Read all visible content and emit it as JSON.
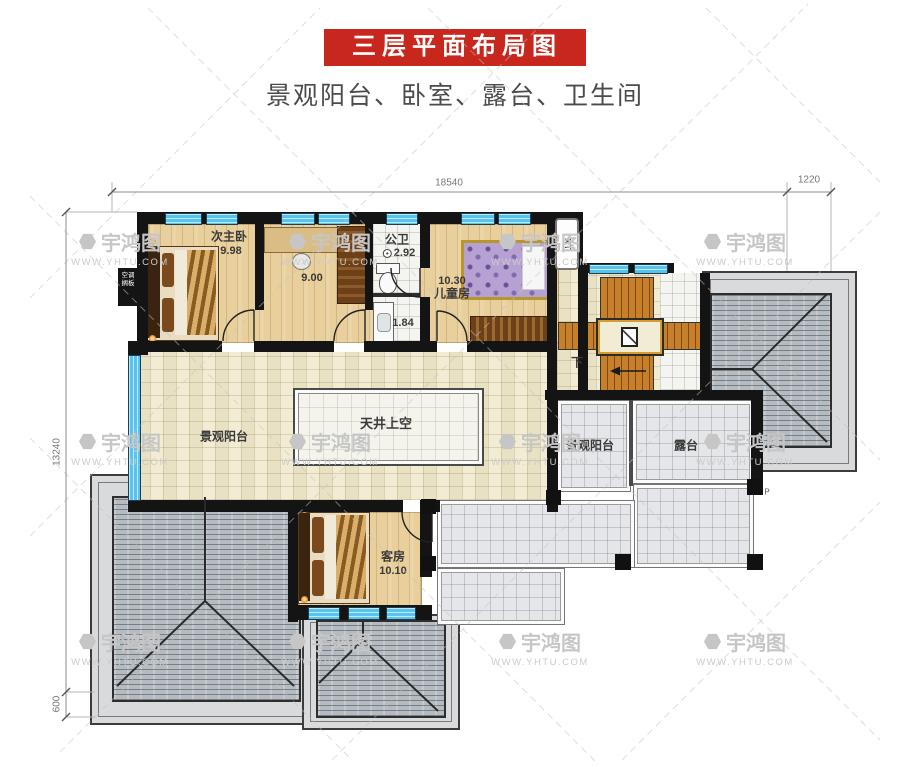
{
  "header": {
    "title": "三层平面布局图",
    "subtitle": "景观阳台、卧室、露台、卫生间",
    "banner_color": "#c8271d"
  },
  "watermark": {
    "brand": "宇鸿图",
    "site": "WWW.YHTU.COM"
  },
  "dimensions": {
    "width_main": "18540",
    "width_right": "1220",
    "height_main": "13240",
    "height_bottom": "600"
  },
  "rooms": {
    "secondary_master": {
      "name": "次主卧",
      "area": "9.98"
    },
    "dressing": {
      "area": "9.00"
    },
    "public_bath": {
      "name": "公卫",
      "area": "2.92"
    },
    "wash": {
      "area": "1.84"
    },
    "kids": {
      "name": "儿童房",
      "area": "10.30"
    },
    "guest": {
      "name": "客房",
      "area": "10.10"
    },
    "balcony_left": {
      "name": "景观阳台"
    },
    "balcony_right": {
      "name": "景观阳台"
    },
    "terrace": {
      "name": "露台"
    },
    "atrium": {
      "name": "天井上空"
    }
  },
  "annotations": {
    "stair_down": "下",
    "kt": "KT",
    "ac_line1": "空调",
    "ac_line2": "搁板",
    "drain_p": "P"
  },
  "colors": {
    "banner": "#c8271d",
    "wall": "#141414",
    "window": "#5ec7ef",
    "wood_floor": "#e9cf9b",
    "pale_floor": "#f2ecd4",
    "gray_tile": "#e5e6e9",
    "roof": "#b4bbc1",
    "stair": "#c87f2a"
  }
}
